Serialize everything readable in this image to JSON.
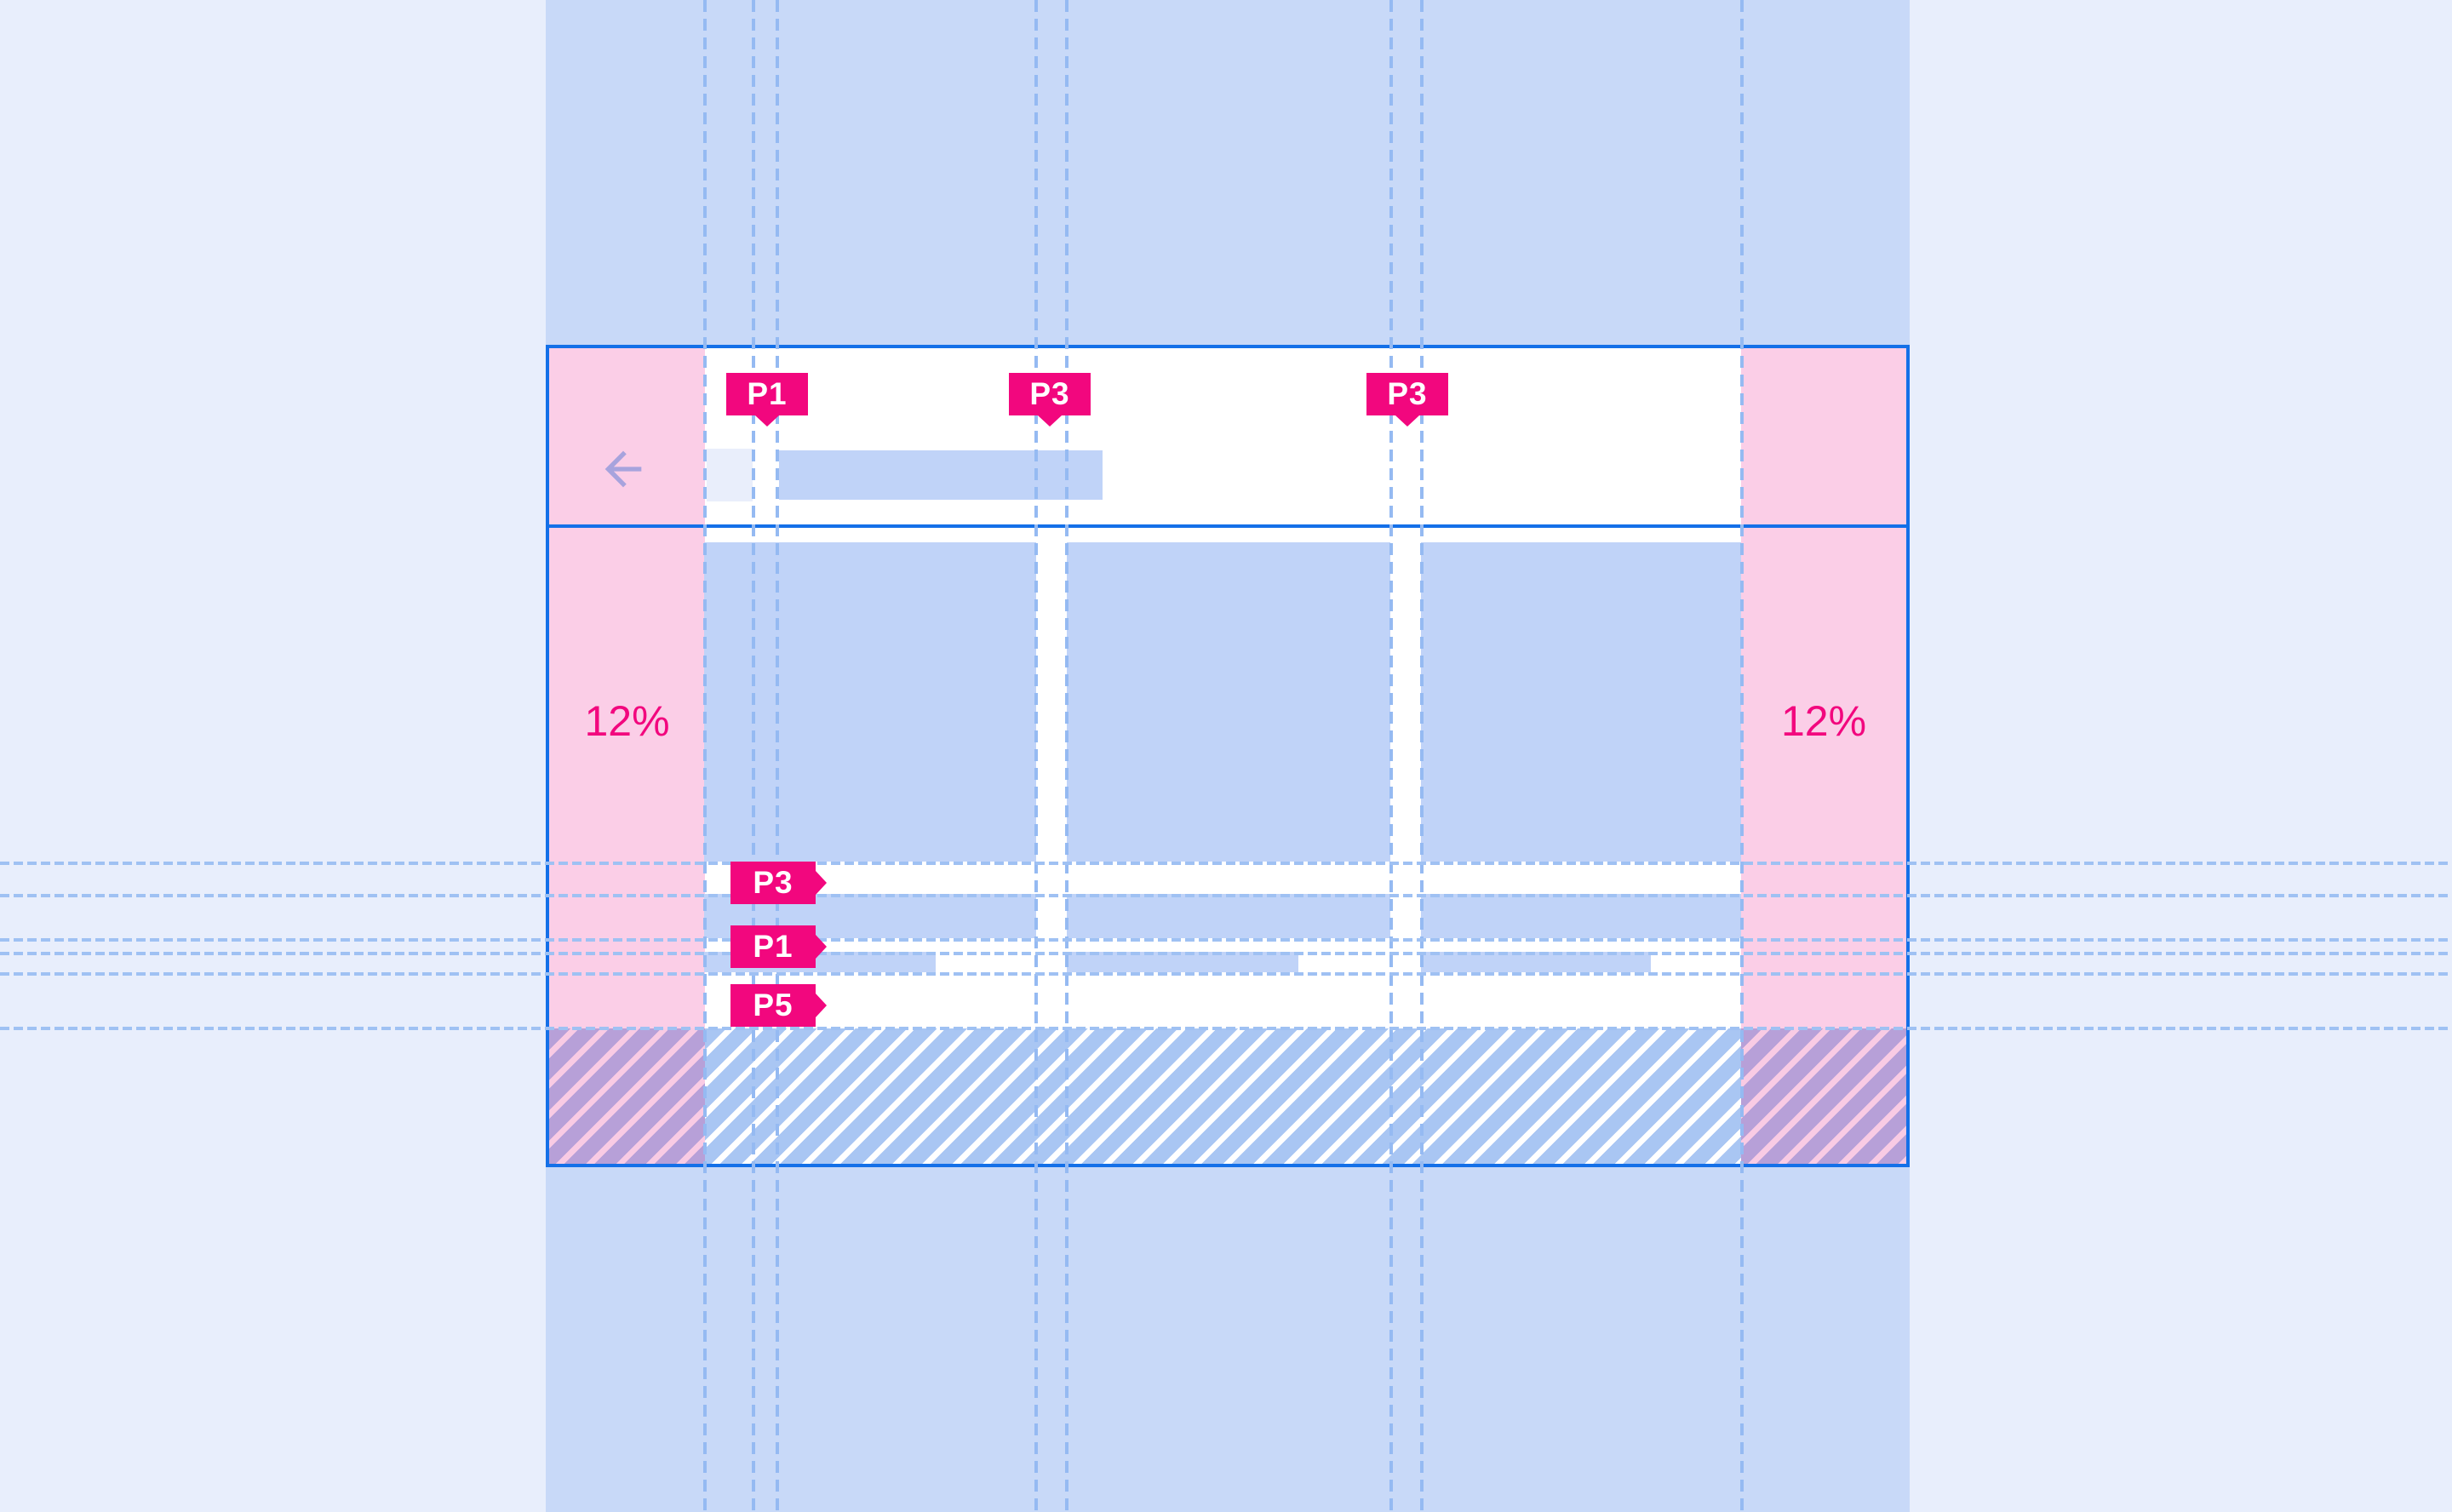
{
  "annotations": {
    "top_paddings": [
      {
        "label": "P1"
      },
      {
        "label": "P3"
      },
      {
        "label": "P3"
      }
    ],
    "side_paddings": [
      {
        "label": "P3"
      },
      {
        "label": "P1"
      },
      {
        "label": "P5"
      }
    ],
    "margins": {
      "left_label": "12%",
      "right_label": "12%"
    }
  },
  "appbar": {
    "back_icon": "arrow-back"
  },
  "colors": {
    "accent_pink": "#f2077e",
    "margin_pink": "#fbcee7",
    "frame_border_blue": "#1470e8",
    "keyline_blue": "#95baf2",
    "placeholder_blue": "#c0d3f8",
    "band_blue": "#c8d9f8",
    "page_background": "#e8eefc",
    "hatch_purple": "#b7a0d8",
    "back_arrow_purple": "#a7a3dd"
  }
}
